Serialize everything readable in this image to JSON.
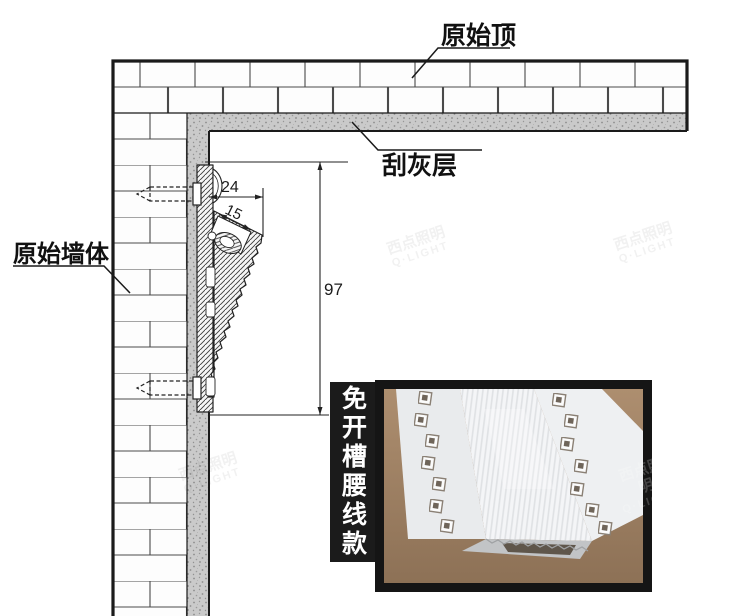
{
  "diagram": {
    "labels": {
      "ceiling": "原始顶",
      "plaster": "刮灰层",
      "wall": "原始墙体"
    },
    "dimensions": {
      "width": "24",
      "slot": "15",
      "height": "97"
    },
    "colors": {
      "line": "#222222",
      "plaster_fill": "#cacaca",
      "brick_fill": "#fdfdfd",
      "photo_background": "#a8886a",
      "label_bar": "#1b1b1b"
    }
  },
  "inset": {
    "label": "免开槽腰线款"
  },
  "watermark": {
    "brand": "西点照明",
    "sub": "Q·LIGHT"
  }
}
